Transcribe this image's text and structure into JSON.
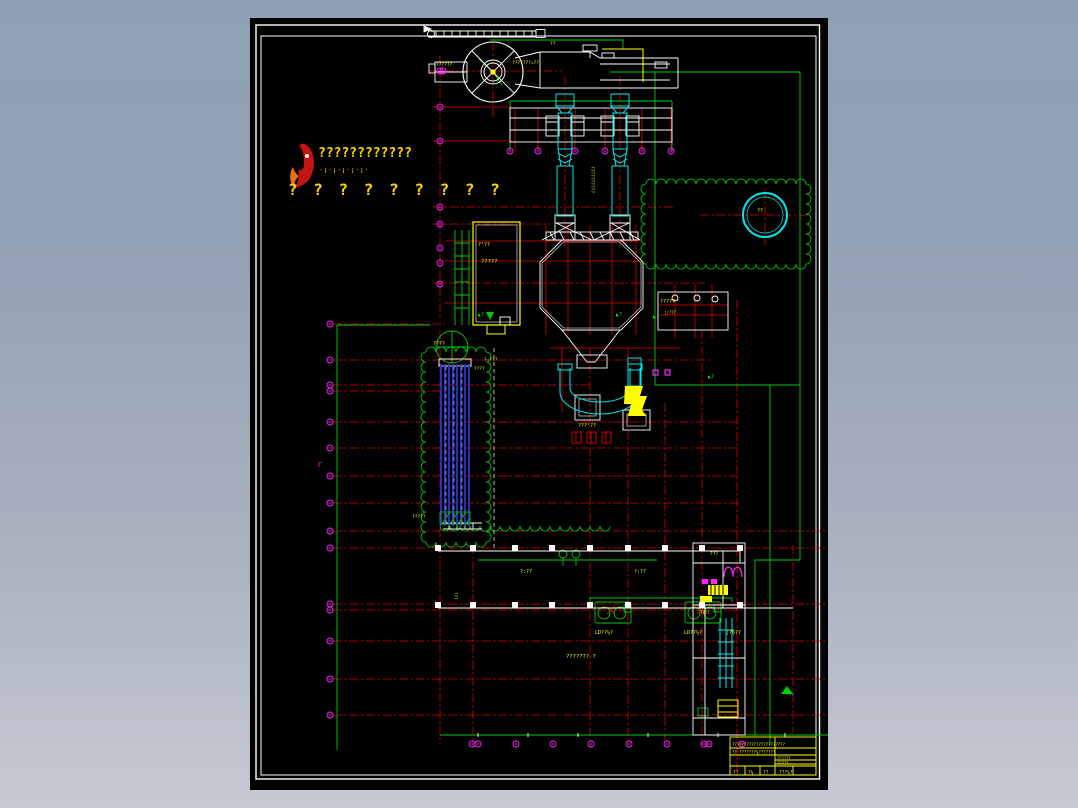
{
  "window": {
    "background_top": "#8fa0b5",
    "background_bottom": "#c5c9d3",
    "canvas_color": "#000000"
  },
  "palette": {
    "grid_red": "#dd0000",
    "boundary_green": "#00cc00",
    "equipment_cyan": "#00e8e8",
    "label_yellow": "#ffff00",
    "axis_magenta": "#ff22ff",
    "stack_blue": "#2b35d0",
    "line_white": "#ffffff",
    "logo_red": "#c41414",
    "logo_orange": "#e87010"
  },
  "logo": {
    "icon": "flame-logo",
    "row1": "????????????",
    "dots": "·¡·¡·¡·¡·¡·",
    "row2": "? ? ? ? ? ? ? ? ?"
  },
  "title_block": {
    "top_row": "??????????????????????",
    "second_row": "??·???????¼???????",
    "right_col": [
      "???????",
      "??????"
    ],
    "cells_bottom": [
      "??",
      "?¼",
      "??",
      "???¼?"
    ]
  },
  "drawing": {
    "bubbles": {
      "left": {
        "x": 80,
        "ys": [
          306,
          342,
          367,
          373,
          404,
          430,
          458,
          485,
          513,
          530,
          586,
          592,
          623,
          661,
          697
        ]
      },
      "colB": {
        "x": 190,
        "ys": [
          53,
          89,
          123,
          189,
          206,
          230,
          245,
          266
        ]
      },
      "bottom": {
        "y": 726,
        "xs": [
          222,
          228,
          266,
          303,
          341,
          379,
          417,
          454,
          459,
          492
        ]
      },
      "platform": {
        "y": 133,
        "xs": [
          260,
          288,
          325,
          355,
          392,
          421
        ]
      },
      "extra": [
        [
          193,
          53
        ]
      ]
    },
    "col_squares": {
      "xs": [
        188,
        223,
        265,
        302,
        340,
        378,
        415,
        452,
        490
      ],
      "rows": [
        530,
        587
      ]
    },
    "labels": [
      {
        "t": "??????",
        "x": 186,
        "y": 48,
        "s": 4.5
      },
      {
        "t": "???????=??",
        "x": 262,
        "y": 46,
        "s": 4.5
      },
      {
        "t": "??????????",
        "x": 341,
        "y": 148,
        "s": 4.5,
        "rot": 90
      },
      {
        "t": "?¹??",
        "x": 228,
        "y": 228,
        "s": 5
      },
      {
        "t": "?????",
        "x": 231,
        "y": 245,
        "s": 5.5
      },
      {
        "t": "????",
        "x": 183,
        "y": 327,
        "s": 5
      },
      {
        "t": "??",
        "x": 507,
        "y": 194,
        "s": 5
      },
      {
        "t": "?????",
        "x": 410,
        "y": 285,
        "s": 5
      },
      {
        "t": "¦¦???",
        "x": 414,
        "y": 296,
        "s": 4
      },
      {
        "t": "?·???",
        "x": 234,
        "y": 343,
        "s": 4.5
      },
      {
        "t": "????",
        "x": 224,
        "y": 352,
        "s": 4.5
      },
      {
        "t": "???²??",
        "x": 328,
        "y": 409,
        "s": 5
      },
      {
        "t": "?????",
        "x": 162,
        "y": 500,
        "s": 4.5
      },
      {
        "t": "???",
        "x": 204,
        "y": 574,
        "s": 4,
        "rot": 90
      },
      {
        "t": "?:??",
        "x": 270,
        "y": 555,
        "s": 5
      },
      {
        "t": "?:??",
        "x": 384,
        "y": 555,
        "s": 5
      },
      {
        "t": "LD??½?",
        "x": 345,
        "y": 616,
        "s": 5
      },
      {
        "t": "LD??½?",
        "x": 434,
        "y": 616,
        "s": 5
      },
      {
        "t": "¦?§??",
        "x": 476,
        "y": 616,
        "s": 5
      },
      {
        "t": "???????·?",
        "x": 316,
        "y": 640,
        "s": 5.5
      },
      {
        "t": "???",
        "x": 460,
        "y": 537,
        "s": 4.5
      },
      {
        "t": "????",
        "x": 450,
        "y": 596,
        "s": 4
      },
      {
        "t": "◣?",
        "x": 228,
        "y": 298,
        "s": 5,
        "c": "#00ff00"
      },
      {
        "t": "◣?",
        "x": 366,
        "y": 298,
        "s": 5,
        "c": "#00ff00"
      },
      {
        "t": "◣?",
        "x": 403,
        "y": 300,
        "s": 5,
        "c": "#00ff00"
      },
      {
        "t": "◣?",
        "x": 458,
        "y": 360,
        "s": 5,
        "c": "#00ff00"
      },
      {
        "t": "Γ",
        "x": 68,
        "y": 449,
        "s": 7,
        "c": "#ff22ff"
      },
      {
        "t": "??",
        "x": 300,
        "y": 27,
        "s": 4.5
      },
      {
        "t": "·??",
        "x": 536,
        "y": 678,
        "s": 4.5,
        "c": "#00ff00"
      }
    ]
  }
}
